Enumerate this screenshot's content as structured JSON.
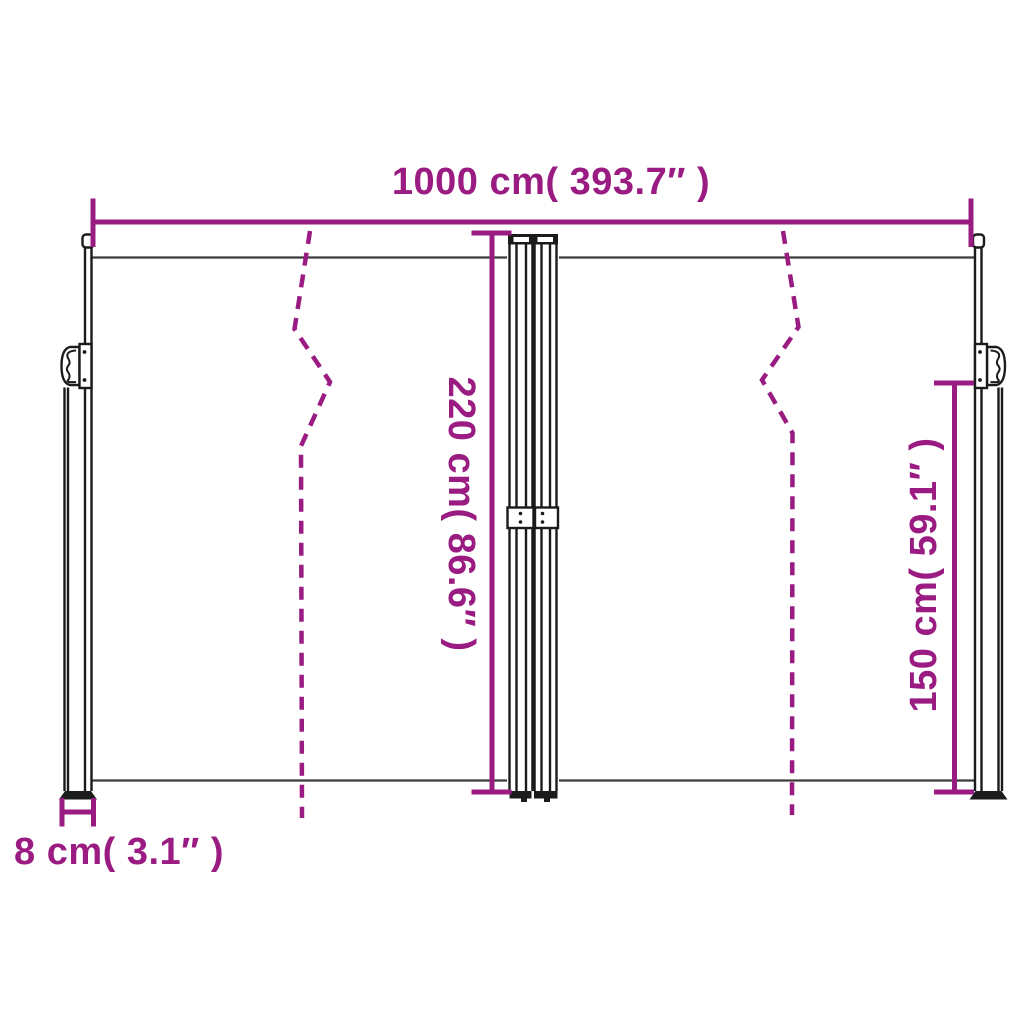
{
  "diagram": {
    "labels": {
      "width": "1000 cm( 393.7″ )",
      "height": "220 cm( 86.6″ )",
      "pole_height": "150 cm( 59.1″ )",
      "pole_depth": "8 cm( 3.1″ )"
    },
    "colors": {
      "dimension": "#9A1C82",
      "outline": "#1b1b1b",
      "fabric_line": "#3c3c3c",
      "background": "#ffffff"
    }
  }
}
